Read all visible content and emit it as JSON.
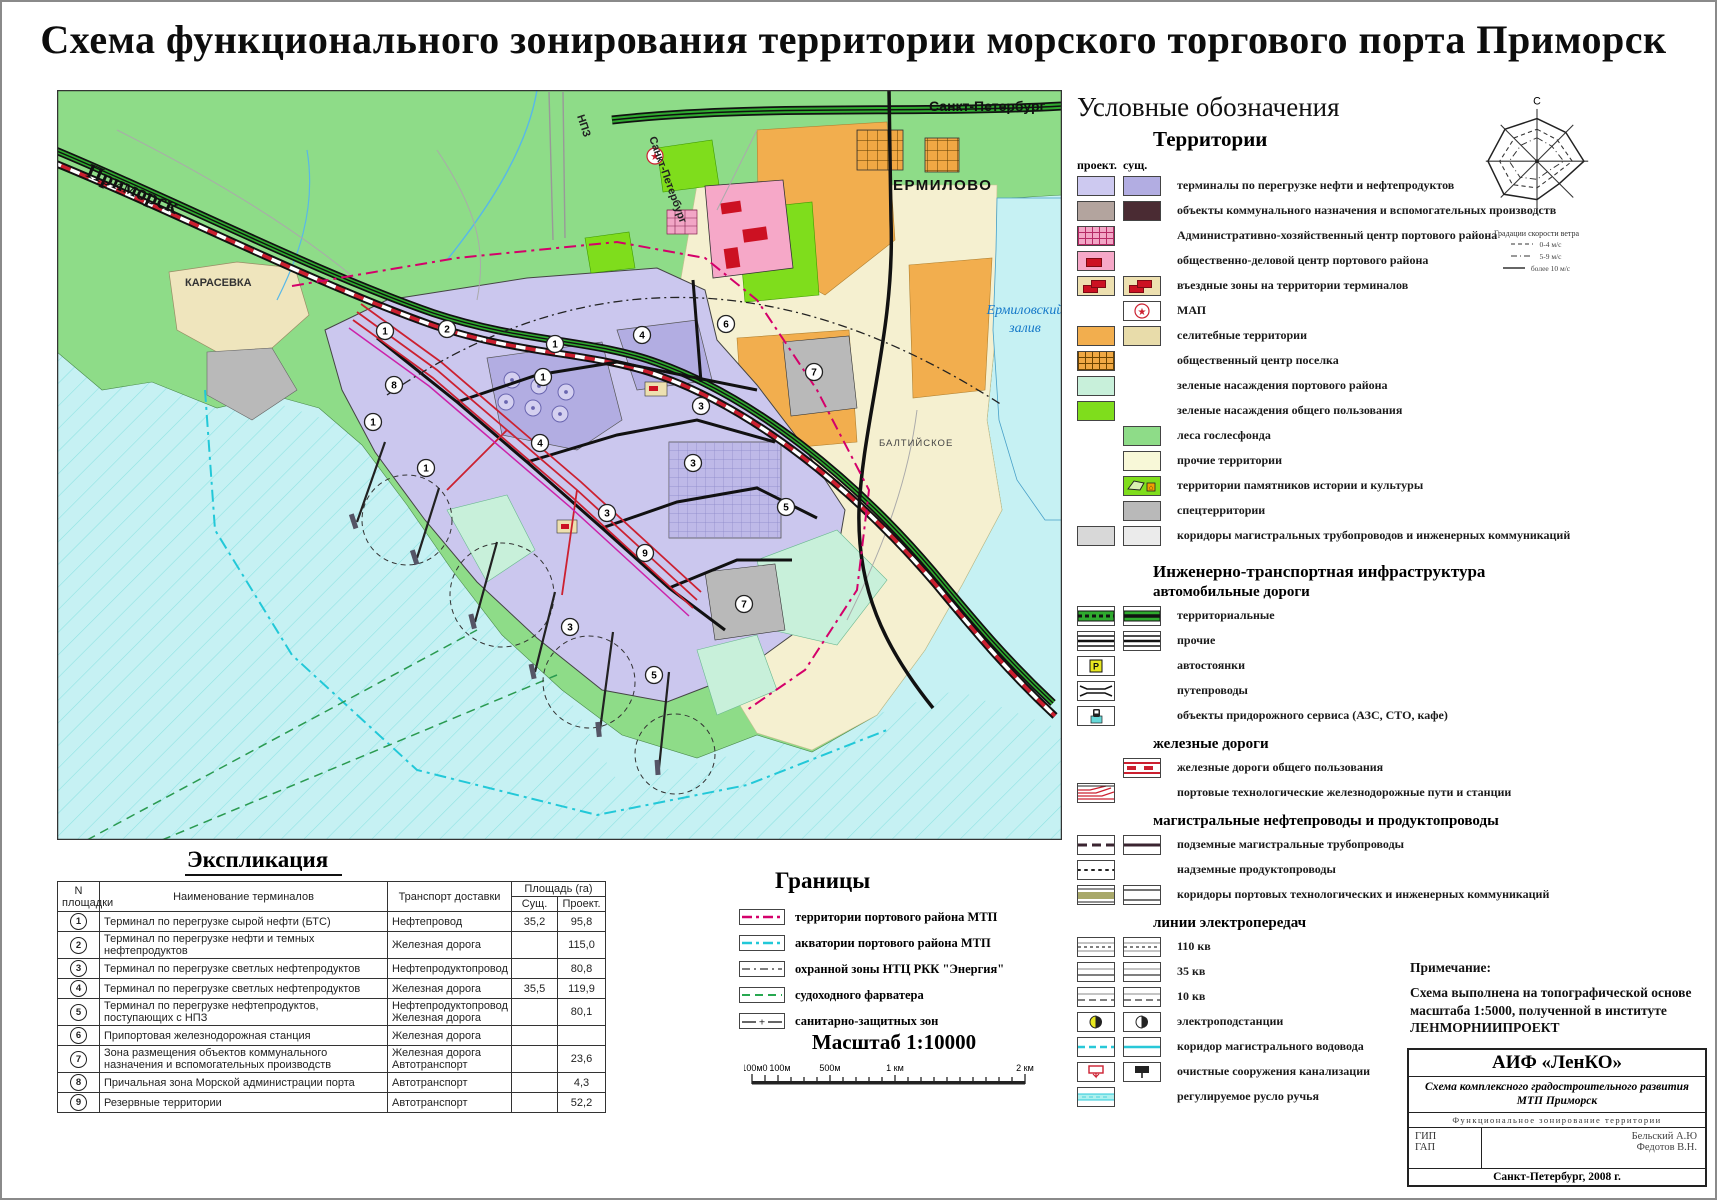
{
  "title": "Схема функционального зонирования территории морского торгового порта Приморск",
  "map": {
    "labels": {
      "primorsk": "Приморск",
      "spb_top": "Санкт-Петербург",
      "spb_road": "Санкт-Петербург",
      "npz": "НПЗ",
      "karasevka": "КАРАСЕВКА",
      "ermilovo": "ЕРМИЛОВО",
      "bay_line1": "Ермиловский",
      "bay_line2": "залив",
      "baltiyskoe": "БАЛТИЙСКОЕ"
    },
    "markers": [
      "1",
      "2",
      "1",
      "4",
      "6",
      "7",
      "8",
      "1",
      "1",
      "4",
      "3",
      "3",
      "5",
      "3",
      "9",
      "7",
      "1",
      "3",
      "5"
    ]
  },
  "windrose": {
    "north": "С",
    "caption": "Градации скорости ветра",
    "grades": [
      "0-4 м/с",
      "5-9 м/с",
      "более 10 м/с"
    ]
  },
  "legend": {
    "title": "Условные обозначения",
    "territories": {
      "heading": "Территории",
      "col_proj": "проект.",
      "col_sush": "сущ.",
      "items": [
        {
          "label": "терминалы по перегрузке нефти и нефтепродуктов"
        },
        {
          "label": "объекты коммунального назначения и вспомогательных производств"
        },
        {
          "label": "Административно-хозяйственный центр портового района"
        },
        {
          "label": "общественно-деловой центр портового района"
        },
        {
          "label": "въездные зоны на территории терминалов"
        },
        {
          "label": "МАП"
        },
        {
          "label": "селитебные территории"
        },
        {
          "label": "общественный центр поселка"
        },
        {
          "label": "зеленые насаждения портового района"
        },
        {
          "label": "зеленые насаждения общего пользования"
        },
        {
          "label": "леса гослесфонда"
        },
        {
          "label": "прочие территории"
        },
        {
          "label": "территории памятников истории и культуры"
        },
        {
          "label": "спецтерритории"
        },
        {
          "label": "коридоры магистральных трубопроводов и инженерных коммуникаций"
        }
      ]
    },
    "infra": {
      "heading": "Инженерно-транспортная инфраструктура",
      "auto": {
        "heading": "автомобильные дороги",
        "items": [
          {
            "label": "территориальные"
          },
          {
            "label": "прочие"
          },
          {
            "label": "автостоянки"
          },
          {
            "label": "путепроводы"
          },
          {
            "label": "объекты придорожного сервиса (АЗС, СТО, кафе)"
          }
        ]
      },
      "rail": {
        "heading": "железные дороги",
        "items": [
          {
            "label": "железные дороги общего пользования"
          },
          {
            "label": "портовые технологические железнодорожные пути и станции"
          }
        ]
      },
      "pipes": {
        "heading": "магистральные нефтепроводы и продуктопроводы",
        "items": [
          {
            "label": "подземные магистральные трубопроводы"
          },
          {
            "label": "надземные продуктопроводы"
          },
          {
            "label": "коридоры портовых технологических и инженерных коммуникаций"
          }
        ]
      },
      "power": {
        "heading": "линии электропередач",
        "items": [
          {
            "label": "110 кв"
          },
          {
            "label": "35 кв"
          },
          {
            "label": "10 кв"
          },
          {
            "label": "электроподстанции"
          },
          {
            "label": "коридор магистрального водовода"
          },
          {
            "label": "очистные сооружения канализации"
          },
          {
            "label": "регулируемое русло ручья"
          }
        ]
      }
    }
  },
  "explication": {
    "title": "Экспликация",
    "col_num": "N площадки",
    "col_name": "Наименование терминалов",
    "col_transport": "Транспорт доставки",
    "col_area": "Площадь (га)",
    "col_sush": "Сущ.",
    "col_proj": "Проект.",
    "rows": [
      {
        "num": "1",
        "name": "Терминал по перегрузке сырой нефти (БТС)",
        "transport": "Нефтепровод",
        "sush": "35,2",
        "proj": "95,8"
      },
      {
        "num": "2",
        "name": "Терминал по перегрузке нефти и темных нефтепродуктов",
        "transport": "Железная дорога",
        "sush": "",
        "proj": "115,0"
      },
      {
        "num": "3",
        "name": "Терминал по перегрузке светлых нефтепродуктов",
        "transport": "Нефтепродуктопровод",
        "sush": "",
        "proj": "80,8"
      },
      {
        "num": "4",
        "name": "Терминал по перегрузке светлых нефтепродуктов",
        "transport": "Железная дорога",
        "sush": "35,5",
        "proj": "119,9"
      },
      {
        "num": "5",
        "name": "Терминал по перегрузке нефтепродуктов, поступающих с НПЗ",
        "transport": "Нефтепродуктопровод\nЖелезная дорога",
        "sush": "",
        "proj": "80,1"
      },
      {
        "num": "6",
        "name": "Припортовая железнодорожная станция",
        "transport": "Железная дорога",
        "sush": "",
        "proj": ""
      },
      {
        "num": "7",
        "name": "Зона размещения объектов коммунального назначения и вспомогательных производств",
        "transport": "Железная дорога\nАвтотранспорт",
        "sush": "",
        "proj": "23,6"
      },
      {
        "num": "8",
        "name": "Причальная зона Морской администрации порта",
        "transport": "Автотранспорт",
        "sush": "",
        "proj": "4,3"
      },
      {
        "num": "9",
        "name": "Резервные территории",
        "transport": "Автотранспорт",
        "sush": "",
        "proj": "52,2"
      }
    ]
  },
  "borders": {
    "title": "Границы",
    "items": [
      {
        "label": "территории портового района МТП"
      },
      {
        "label": "акватории портового района МТП"
      },
      {
        "label": "охранной зоны НТЦ РКК \"Энергия\""
      },
      {
        "label": "судоходного фарватера"
      },
      {
        "label": "санитарно-защитных зон"
      }
    ]
  },
  "scale": {
    "label": "Масштаб 1:10000",
    "ticks": [
      "100м",
      "0",
      "100м",
      "500м",
      "1 км",
      "2 км"
    ]
  },
  "note": {
    "heading": "Примечание:",
    "text": "Схема выполнена на топографической основе масштаба 1:5000, полученной в институте ЛЕНМОРНИИПРОЕКТ"
  },
  "stamp": {
    "org": "АИФ «ЛенКО»",
    "project": "Схема комплексного градостроительного развития МТП Приморск",
    "subtitle": "Функциональное зонирование территории",
    "row1_label": "ГИП",
    "row1_value": "Бельский А.Ю",
    "row2_label": "ГАП",
    "row2_value": "Федотов В.Н.",
    "city": "Санкт-Петербург, 2008 г."
  }
}
